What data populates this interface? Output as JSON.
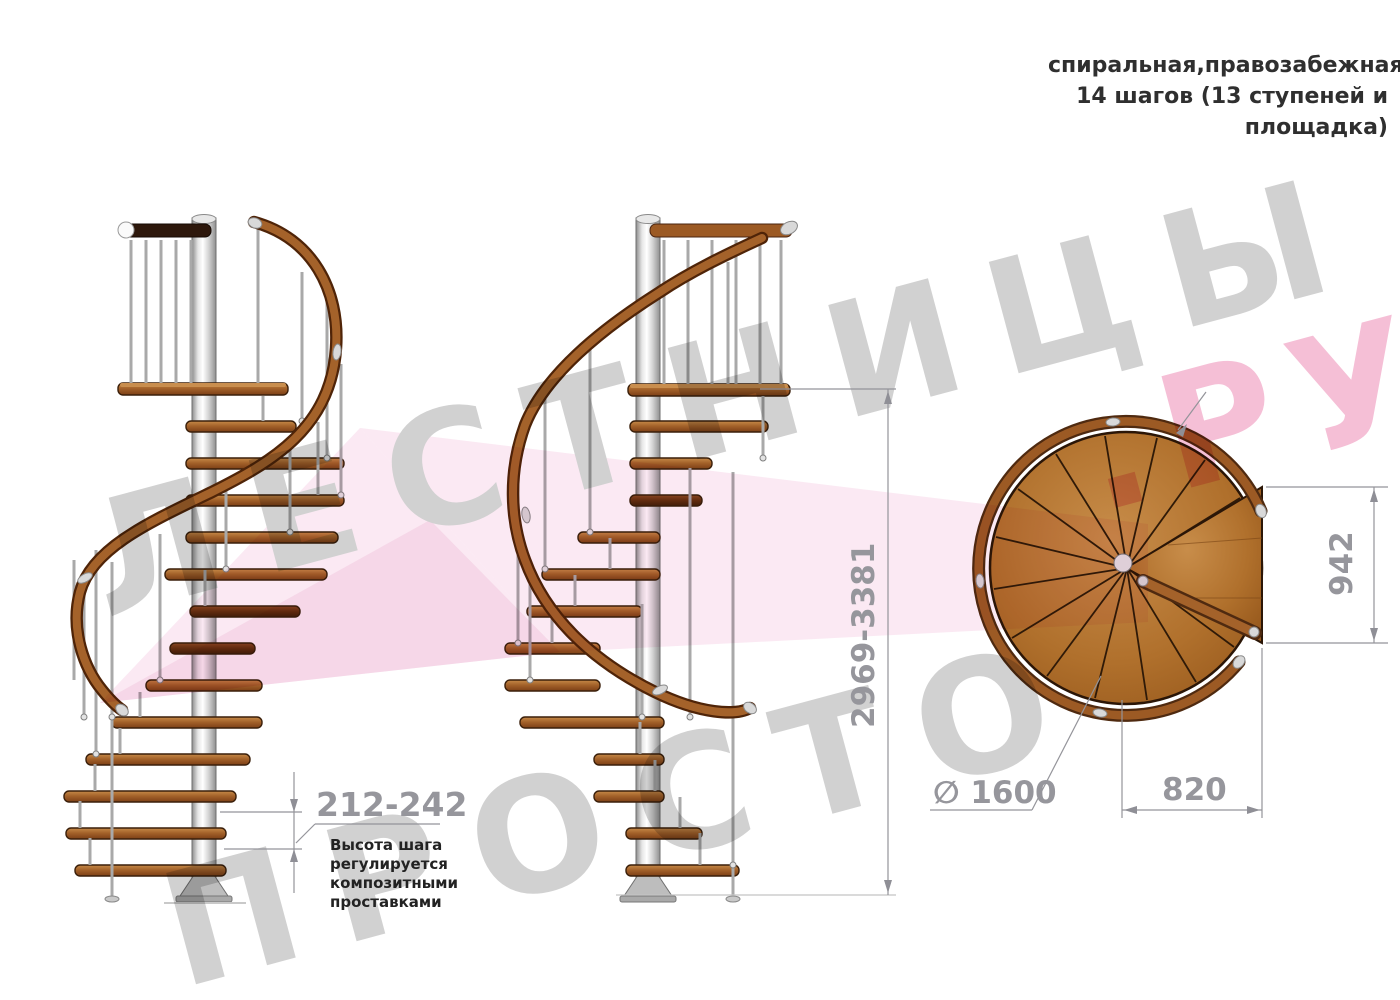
{
  "title_block": {
    "lines": [
      "спиральная,правозабежная",
      "14 шагов (13 ступеней и",
      "площадка)"
    ]
  },
  "dimensions": {
    "step_height": "212-242",
    "step_height_note": "Высота шага регулируется композитными проставками",
    "total_height": "2969-3381",
    "platform_depth": "942",
    "diameter": "∅ 1600",
    "entry_width": "820"
  },
  "watermark": {
    "line1": "ЛЕСТНИЦЫ",
    "line2": "ПРОСТО",
    "suffix": ".РУ"
  },
  "colors": {
    "wood": "#a4622a",
    "wood_dark": "#6e3817",
    "handrail": "#9c5a24",
    "metal": "#d9d9d9",
    "dimension": "#96969c",
    "watermark_gray": "#cccccc",
    "watermark_pink": "#f4b8d2",
    "ribbon_pink": "#f6d2e6"
  }
}
